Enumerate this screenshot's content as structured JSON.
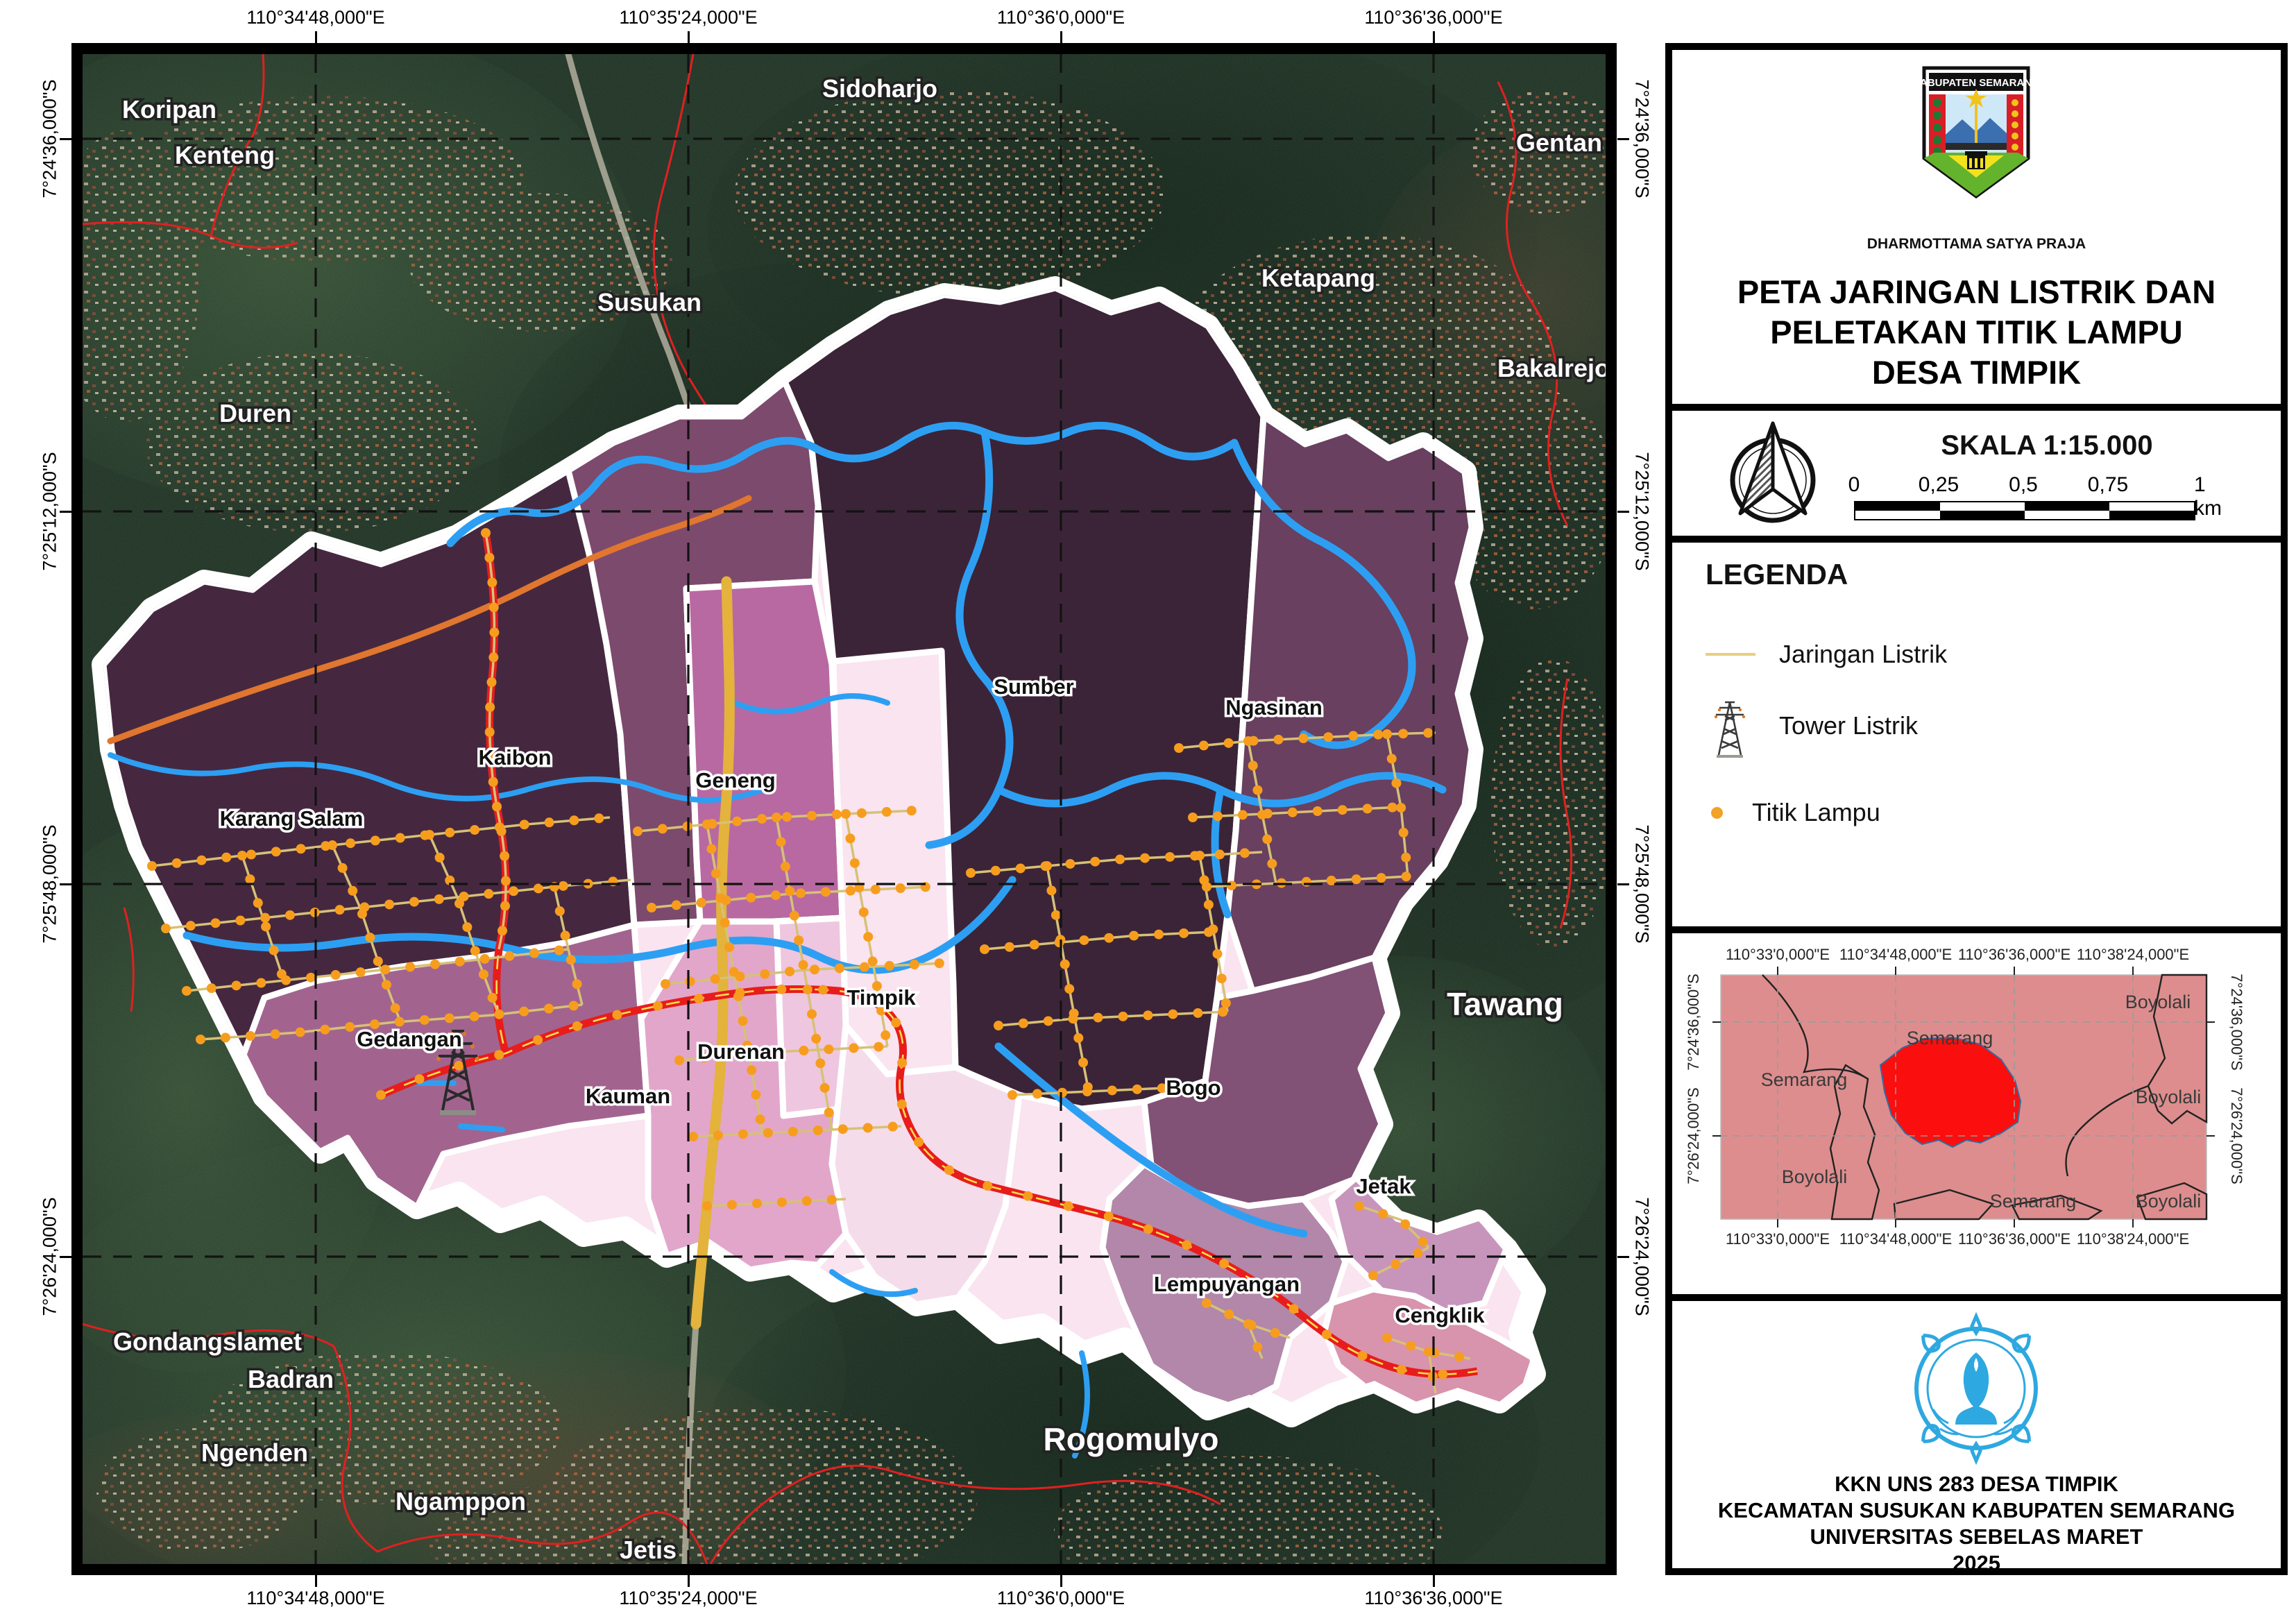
{
  "colors": {
    "river": "#2d9ff3",
    "road_red": "#e81c1c",
    "road_center_yellow": "#f7e04b",
    "road_orange": "#e0762f",
    "highway_amber": "#e3b33c",
    "wire_khaki": "#d6c177",
    "lamp_orange": "#f79d1e",
    "boundary_white": "#ffffff",
    "grid_black": "#131313",
    "admin_red": "#e02020",
    "region_darkest": "#3c2438",
    "region_dark": "#452840",
    "region_kaibon": "#7c4a6d",
    "region_ngasinan": "#69405f",
    "region_geneng": "#b869a2",
    "region_light": "#f9e4f0",
    "region_timpik": "#f5dceb",
    "region_kauman": "#e2a6cb",
    "region_durenan": "#efc6df",
    "region_gedangan": "#a2648f",
    "region_bogo": "#825176",
    "region_jetak": "#c795bb",
    "region_lempuyangan": "#b287a9",
    "region_cengklik": "#d893ad",
    "inset_pink": "#dd8d8d",
    "inset_red": "#fb0e0e",
    "uns_blue": "#2ea8e0"
  },
  "map": {
    "lon_labels": [
      "110°34'48,000\"E",
      "110°35'24,000\"E",
      "110°36'0,000\"E",
      "110°36'36,000\"E"
    ],
    "lat_labels": [
      "7°24'36,000\"S",
      "7°25'12,000\"S",
      "7°25'48,000\"S",
      "7°26'24,000\"S"
    ],
    "context_labels": {
      "koripan": "Koripan",
      "kenteng": "Kenteng",
      "sidoharjo": "Sidoharjo",
      "gentan": "Gentan",
      "duren": "Duren",
      "susukan": "Susukan",
      "ketapang": "Ketapang",
      "bakalrejo": "Bakalrejo",
      "tawang": "Tawang",
      "gondangslamet": "Gondangslamet",
      "badran": "Badran",
      "ngenden": "Ngenden",
      "ngamppon": "Ngamppon",
      "jetis": "Jetis",
      "rogomulyo": "Rogomulyo"
    },
    "village_labels": {
      "karang_salam": "Karang Salam",
      "kaibon": "Kaibon",
      "geneng": "Geneng",
      "sumber": "Sumber",
      "ngasinan": "Ngasinan",
      "timpik": "Timpik",
      "gedangan": "Gedangan",
      "durenan": "Durenan",
      "kauman": "Kauman",
      "bogo": "Bogo",
      "jetak": "Jetak",
      "lempuyangan": "Lempuyangan",
      "cengklik": "Cengklik"
    }
  },
  "panel": {
    "crest": {
      "name": "KABUPATEN SEMARANG",
      "motto": "DHARMOTTAMA SATYA PRAJA"
    },
    "title_lines": [
      "PETA JARINGAN LISTRIK DAN",
      "PELETAKAN TITIK LAMPU",
      "DESA TIMPIK"
    ],
    "scale": {
      "heading": "SKALA 1:15.000",
      "ticks": [
        "0",
        "0,25",
        "0,5",
        "0,75",
        "1 km"
      ]
    },
    "legend": {
      "heading": "LEGENDA",
      "jaringan": "Jaringan Listrik",
      "tower": "Tower Listrik",
      "titik": "Titik Lampu"
    },
    "inset": {
      "lon_labels": [
        "110°33'0,000\"E",
        "110°34'48,000\"E",
        "110°36'36,000\"E",
        "110°38'24,000\"E"
      ],
      "lat_labels": [
        "7°24'36,000\"S",
        "7°26'24,000\"S"
      ],
      "region_labels": {
        "semarang_w": "Semarang",
        "semarang_c": "Semarang",
        "semarang_s": "Semarang",
        "boyolali_ne": "Boyolali",
        "boyolali_e": "Boyolali",
        "boyolali_sw": "Boyolali",
        "boyolali_se": "Boyolali"
      }
    },
    "credits": [
      "KKN UNS 283 DESA TIMPIK",
      "KECAMATAN SUSUKAN KABUPATEN SEMARANG",
      "UNIVERSITAS SEBELAS MARET",
      "2025"
    ]
  }
}
